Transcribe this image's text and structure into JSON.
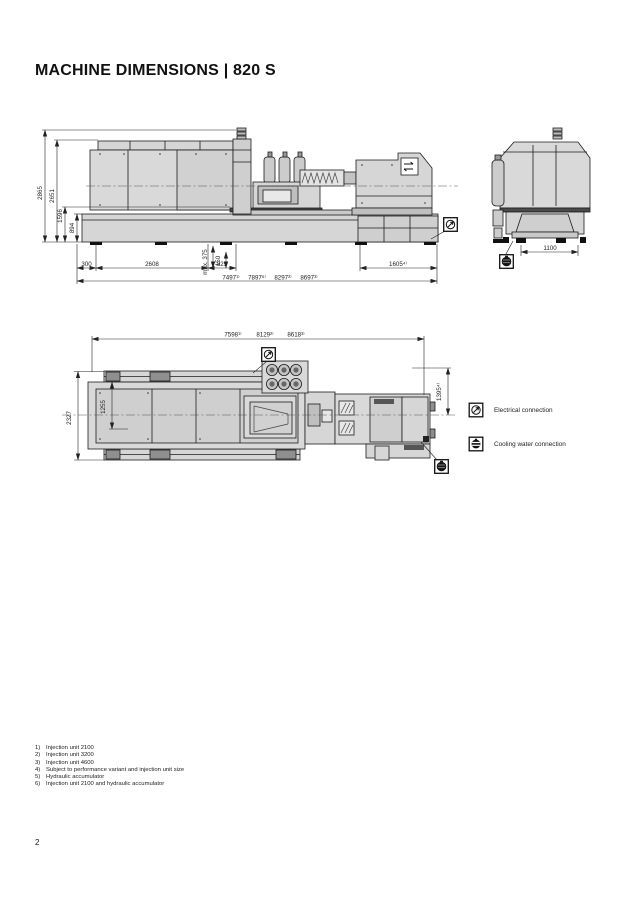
{
  "page": {
    "title": "MACHINE DIMENSIONS | 820 S",
    "page_number": "2"
  },
  "side_view": {
    "heights": {
      "overall": "2865",
      "guard": "2651",
      "mid": "1596",
      "base": "894"
    },
    "verticals": {
      "max_stroke": "max. 375",
      "offset": "150"
    },
    "segments": {
      "left": "300",
      "clamp": "2608",
      "mid": "825",
      "right": "1605⁴⁾"
    },
    "totals": [
      "7497¹⁾",
      "7897⁶⁾",
      "8297²⁾",
      "8697³⁾"
    ]
  },
  "front_view": {
    "base_width": "1100"
  },
  "top_view": {
    "totals": [
      "7598¹⁾",
      "8129²⁾",
      "8618³⁾"
    ],
    "widths": {
      "overall": "2327",
      "inner": "1255",
      "right": "1395⁴⁾"
    }
  },
  "legend": {
    "electrical": "Electrical connection",
    "cooling": "Cooling water connection"
  },
  "footnotes": [
    {
      "num": "1)",
      "text": "Injection unit 2100"
    },
    {
      "num": "2)",
      "text": "Injection unit 3200"
    },
    {
      "num": "3)",
      "text": "Injection unit 4600"
    },
    {
      "num": "4)",
      "text": "Subject to performance variant and injection unit size"
    },
    {
      "num": "5)",
      "text": "Hydraulic accumulator"
    },
    {
      "num": "6)",
      "text": "Injection unit 2100 and hydraulic accumulator"
    }
  ]
}
